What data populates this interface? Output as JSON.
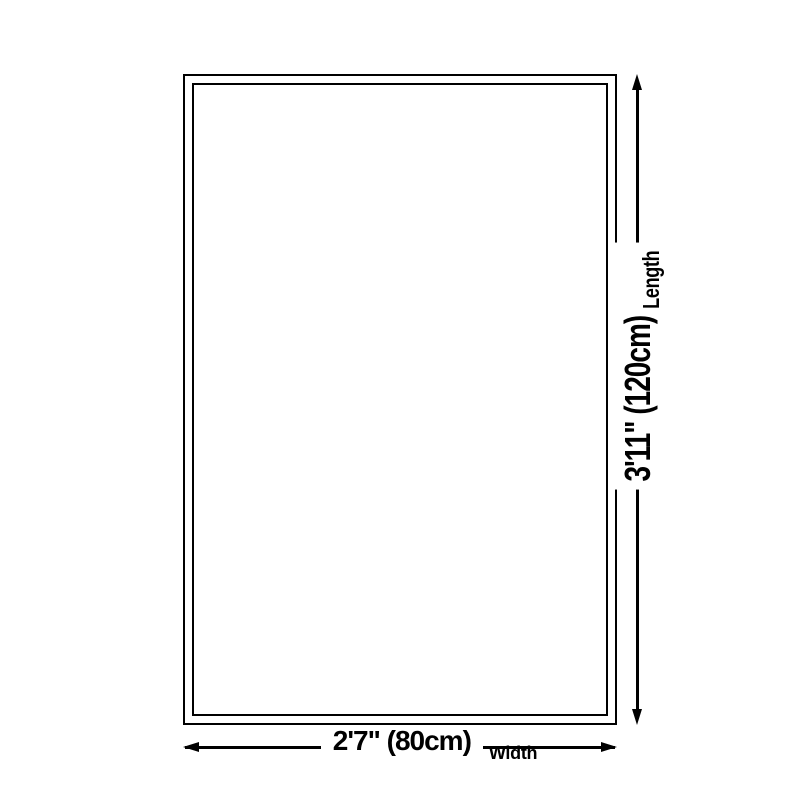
{
  "diagram": {
    "length": {
      "dimension": "3'11\" (120cm)",
      "label": "Length"
    },
    "width": {
      "dimension": "2'7\" (80cm)",
      "label": "Width"
    },
    "colors": {
      "line": "#000000",
      "background": "#ffffff"
    }
  }
}
